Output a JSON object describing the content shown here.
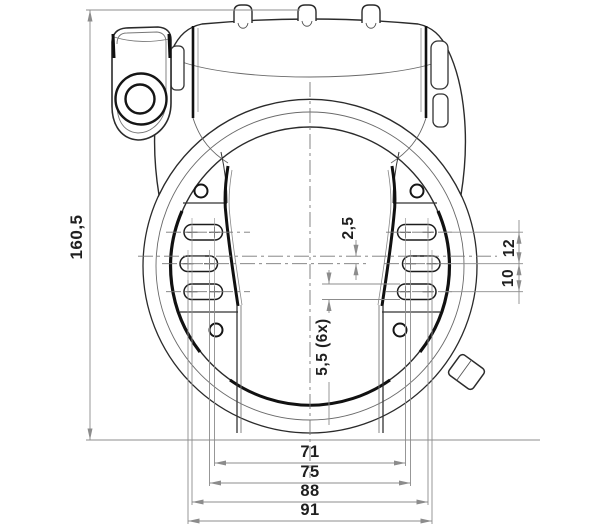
{
  "drawing": {
    "title": "frame-lock-technical-drawing",
    "dim_overall_height": "160,5",
    "dim_slot_offset": "2,5",
    "dim_slot_width": "5,5 (6x)",
    "dim_row_spacing_upper": "12",
    "dim_row_spacing_lower": "10",
    "dim_span_inner": "71",
    "dim_span_mid": "75",
    "dim_span_outer": "88",
    "dim_span_max": "91"
  },
  "colors": {
    "outline": "#2b2b2b",
    "heavy_line": "#111111",
    "secondary_line": "#6a6a6a",
    "dimension_line": "#8c8c8c",
    "centerline": "#777777",
    "background": "#ffffff"
  }
}
